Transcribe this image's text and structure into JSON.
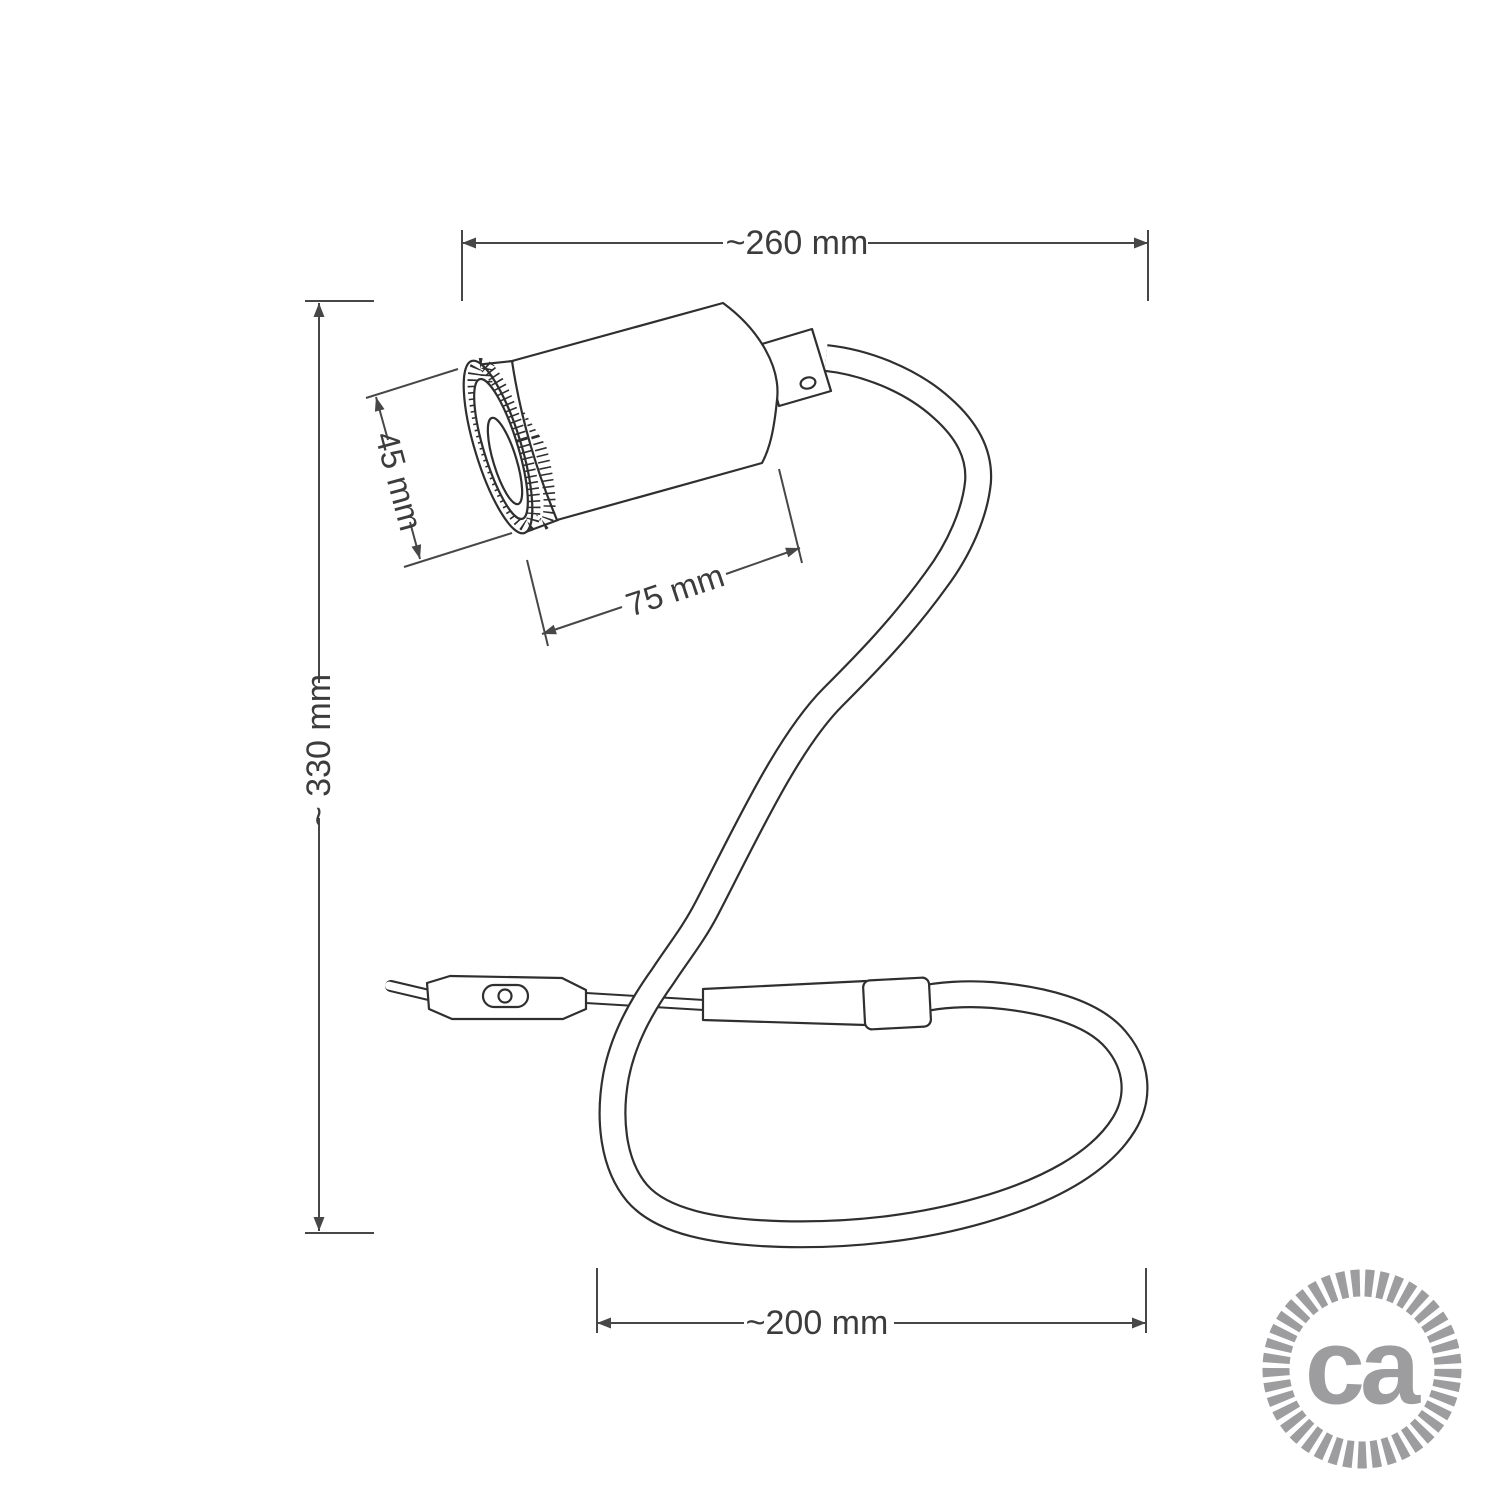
{
  "diagram": {
    "description": "Technical dimension line drawing of a flexible gooseneck spot lamp: cylindrical spotlight head with knurled front ring, square swivel joint, S-curved flexible stem ending in a floor loop, inline cord switch and cable",
    "dimension_labels": {
      "overall_width": "~260 mm",
      "overall_height": "~ 330 mm",
      "head_diameter": "45 mm",
      "head_length": "75 mm",
      "loop_width": "~200 mm"
    },
    "colors": {
      "drawing_line": "#2f2f2f",
      "dimension_line": "#474747",
      "dimension_text": "#3c3c3c",
      "logo": "#9d9da0",
      "background": "#ffffff"
    }
  },
  "logo": {
    "text": "ca",
    "style": "rope-circle-badge"
  }
}
